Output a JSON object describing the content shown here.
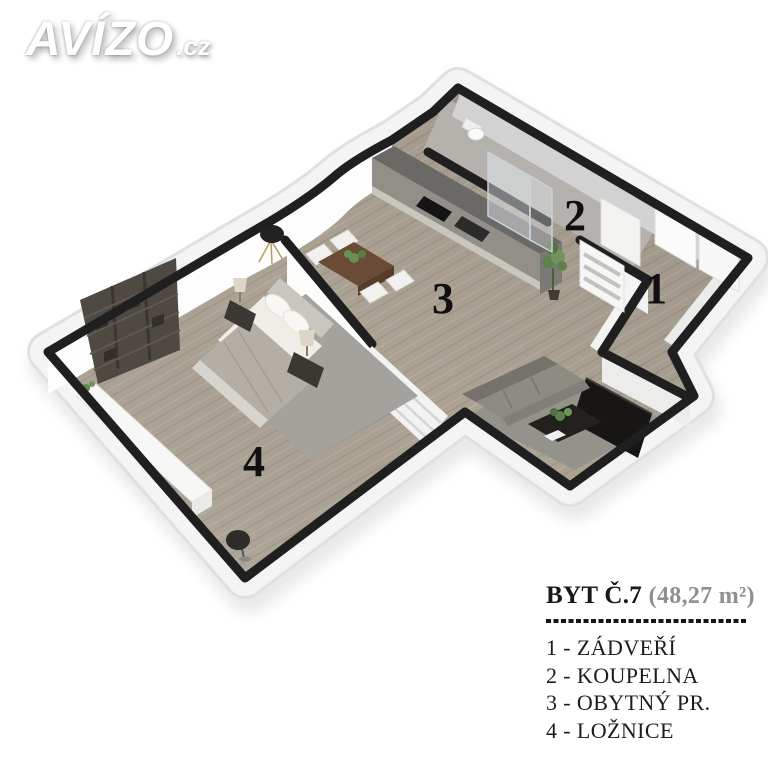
{
  "logo": {
    "brand": "AVÍZO",
    "tld": ".cz"
  },
  "floor_plan": {
    "room_numbers": {
      "r1": "1",
      "r2": "2",
      "r3": "3",
      "r4": "4"
    },
    "colors": {
      "background": "#ffffff",
      "wall_top": "#1f1f1f",
      "wall_face": "#f4f4f4",
      "wood_floor": "#aca395",
      "bathroom_floor": "#b5b2ad",
      "kitchen_dark": "#6b6966",
      "sofa_gray": "#8e8b84",
      "furniture_dark": "#3b3732",
      "plant_green": "#5e814c"
    }
  },
  "legend": {
    "title": "BYT Č.7",
    "area": "(48,27 m²)",
    "items": [
      {
        "label": "1 - ZÁDVEŘÍ"
      },
      {
        "label": "2 - KOUPELNA"
      },
      {
        "label": "3 - OBYTNÝ PR."
      },
      {
        "label": "4 - LOŽNICE"
      }
    ]
  }
}
